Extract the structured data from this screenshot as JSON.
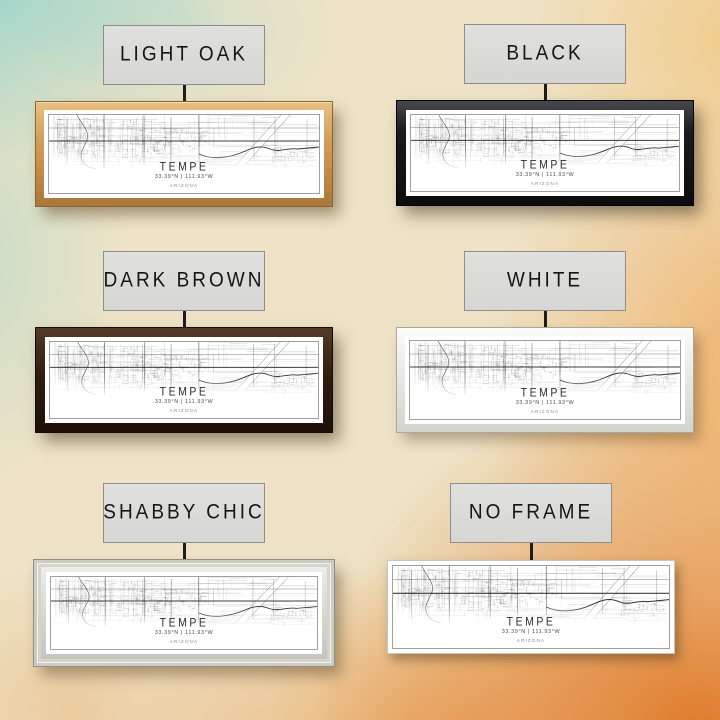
{
  "print": {
    "city": "TEMPE",
    "coordinates": "33.39°N | 111.93°W",
    "state": "ARIZONA"
  },
  "options": [
    {
      "id": "light-oak",
      "label": "LIGHT OAK",
      "frame_color": "#c99a5e"
    },
    {
      "id": "black",
      "label": "BLACK",
      "frame_color": "#141417"
    },
    {
      "id": "dark-brown",
      "label": "DARK BROWN",
      "frame_color": "#322012"
    },
    {
      "id": "white",
      "label": "WHITE",
      "frame_color": "#ececea"
    },
    {
      "id": "shabby-chic",
      "label": "SHABBY CHIC",
      "frame_color": "#d9d9d3"
    },
    {
      "id": "no-frame",
      "label": "NO FRAME",
      "frame_color": "none"
    }
  ],
  "palette": {
    "wall_teal": "#8fd2cf",
    "wall_cream": "#eee3c6",
    "wall_orange": "#df7622",
    "label_bg": "#dbdbd9",
    "label_border": "#8d8d8b",
    "label_text": "#161616"
  }
}
